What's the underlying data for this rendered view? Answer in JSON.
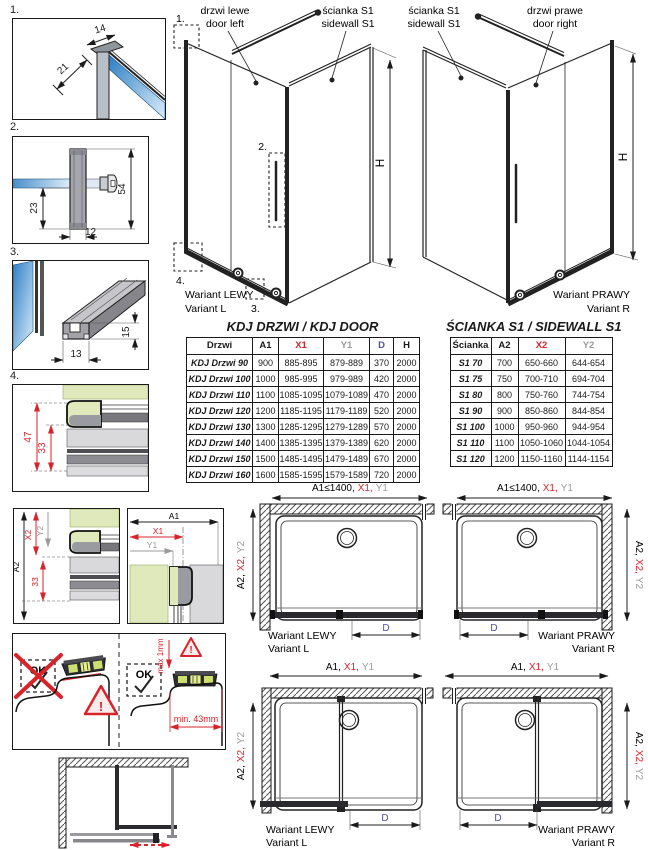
{
  "colors": {
    "accent_red": "#d8232a",
    "label_gray": "#9b9b9b",
    "d_purple": "#50509e",
    "wall_green": "#dfe9bb",
    "glass_blue": "#2e7ec3"
  },
  "callouts": {
    "n1": "1.",
    "n2": "2.",
    "n3": "3.",
    "n4": "4."
  },
  "details": {
    "d1": {
      "dim_width": "14",
      "dim_diag": "21"
    },
    "d2": {
      "dim_height": "54",
      "dim_inner": "23",
      "dim_width": "12"
    },
    "d3": {
      "dim_height": "15",
      "dim_width": "13"
    },
    "d4": {
      "dim_outer": "47",
      "dim_inner": "33"
    },
    "d5": {
      "a2": "A2",
      "x2": "X2",
      "y2": "Y2",
      "dim33": "33",
      "a1": "A1",
      "x1": "X1",
      "y1": "Y1"
    }
  },
  "install": {
    "ok": "OK",
    "max_gap": "max 1mm",
    "min_width": "min. 43mm",
    "warn": "!"
  },
  "drawings": {
    "left": {
      "door_pl": "drzwi lewe",
      "door_en": "door left",
      "wall_pl": "ścianka S1",
      "wall_en": "sidewall S1",
      "variant_pl": "Wariant LEWY",
      "variant_en": "Variant L",
      "height": "H"
    },
    "right": {
      "wall_pl": "ścianka S1",
      "wall_en": "sidewall S1",
      "door_pl": "drzwi prawe",
      "door_en": "door right",
      "variant_pl": "Wariant PRAWY",
      "variant_en": "Variant R",
      "height": "H"
    }
  },
  "door_table": {
    "title": "KDJ DRZWI / KDJ DOOR",
    "headers": [
      "Drzwi",
      "A1",
      "X1",
      "Y1",
      "D",
      "H"
    ],
    "header_colors": [
      "#1a1a1a",
      "#1a1a1a",
      "#d8232a",
      "#9b9b9b",
      "#50509e",
      "#1a1a1a"
    ],
    "rows": [
      [
        "KDJ Drzwi 90",
        "900",
        "885-895",
        "879-889",
        "370",
        "2000"
      ],
      [
        "KDJ Drzwi 100",
        "1000",
        "985-995",
        "979-989",
        "420",
        "2000"
      ],
      [
        "KDJ Drzwi 110",
        "1100",
        "1085-1095",
        "1079-1089",
        "470",
        "2000"
      ],
      [
        "KDJ Drzwi 120",
        "1200",
        "1185-1195",
        "1179-1189",
        "520",
        "2000"
      ],
      [
        "KDJ Drzwi 130",
        "1300",
        "1285-1295",
        "1279-1289",
        "570",
        "2000"
      ],
      [
        "KDJ Drzwi 140",
        "1400",
        "1385-1395",
        "1379-1389",
        "620",
        "2000"
      ],
      [
        "KDJ Drzwi 150",
        "1500",
        "1485-1495",
        "1479-1489",
        "670",
        "2000"
      ],
      [
        "KDJ Drzwi 160",
        "1600",
        "1585-1595",
        "1579-1589",
        "720",
        "2000"
      ]
    ]
  },
  "sidewall_table": {
    "title": "ŚCIANKA S1 / SIDEWALL S1",
    "headers": [
      "Ścianka",
      "A2",
      "X2",
      "Y2"
    ],
    "header_colors": [
      "#1a1a1a",
      "#1a1a1a",
      "#d8232a",
      "#9b9b9b"
    ],
    "rows": [
      [
        "S1 70",
        "700",
        "650-660",
        "644-654"
      ],
      [
        "S1 75",
        "750",
        "700-710",
        "694-704"
      ],
      [
        "S1 80",
        "800",
        "750-760",
        "744-754"
      ],
      [
        "S1 90",
        "900",
        "850-860",
        "844-854"
      ],
      [
        "S1 100",
        "1000",
        "950-960",
        "944-954"
      ],
      [
        "S1 110",
        "1100",
        "1050-1060",
        "1044-1054"
      ],
      [
        "S1 120",
        "1200",
        "1150-1160",
        "1144-1154"
      ]
    ]
  },
  "plans": {
    "top_a1": "A1≤1400,",
    "x1": "X1,",
    "y1": "Y1",
    "bot_a1": "A1,",
    "a2": "A2,",
    "x2": "X2,",
    "y2": "Y2",
    "d": "D",
    "variant_left_pl": "Wariant LEWY",
    "variant_left_en": "Variant L",
    "variant_right_pl": "Wariant PRAWY",
    "variant_right_en": "Variant R"
  }
}
